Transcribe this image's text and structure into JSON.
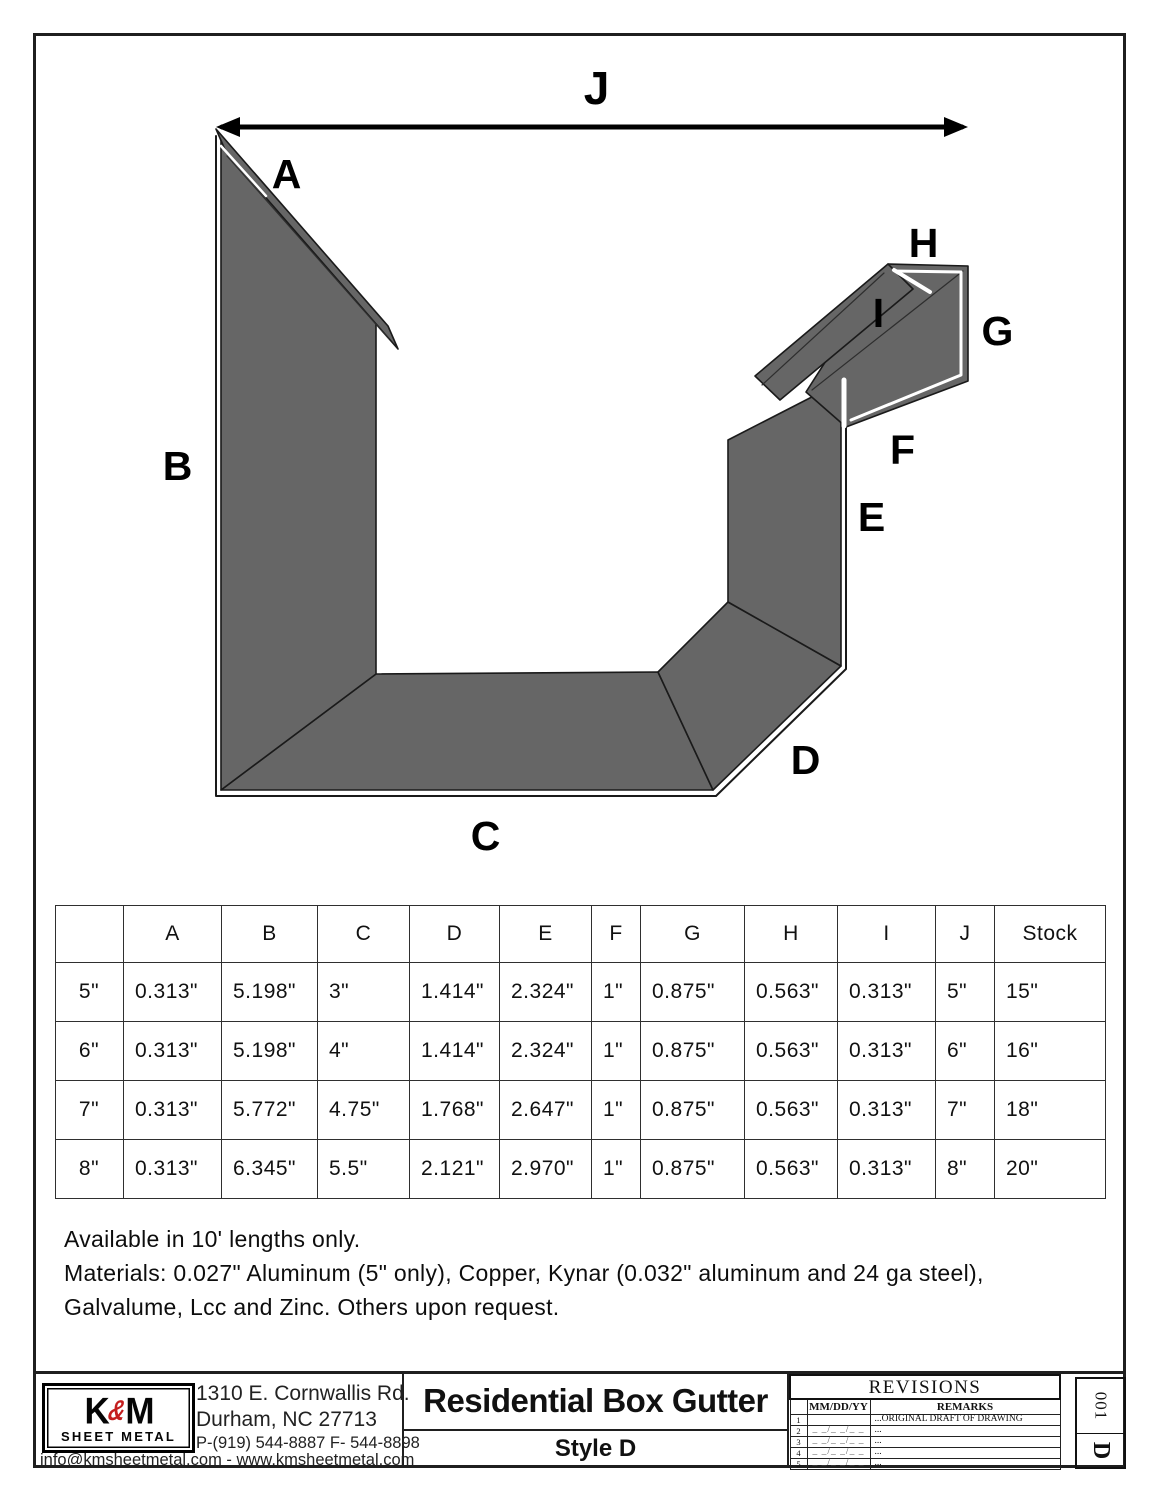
{
  "colors": {
    "metal_fill": "#666666",
    "outline": "#1a1a1a",
    "logo_red": "#c41e1e"
  },
  "diagram": {
    "labels": {
      "a": "A",
      "b": "B",
      "c": "C",
      "d": "D",
      "e": "E",
      "f": "F",
      "g": "G",
      "h": "H",
      "i": "I",
      "j": "J"
    }
  },
  "spec_table": {
    "columns": [
      "",
      "A",
      "B",
      "C",
      "D",
      "E",
      "F",
      "G",
      "H",
      "I",
      "J",
      "Stock"
    ],
    "rows": [
      {
        "size": "5\"",
        "cells": [
          "0.313\"",
          "5.198\"",
          "3\"",
          "1.414\"",
          "2.324\"",
          "1\"",
          "0.875\"",
          "0.563\"",
          "0.313\"",
          "5\"",
          "15\""
        ]
      },
      {
        "size": "6\"",
        "cells": [
          "0.313\"",
          "5.198\"",
          "4\"",
          "1.414\"",
          "2.324\"",
          "1\"",
          "0.875\"",
          "0.563\"",
          "0.313\"",
          "6\"",
          "16\""
        ]
      },
      {
        "size": "7\"",
        "cells": [
          "0.313\"",
          "5.772\"",
          "4.75\"",
          "1.768\"",
          "2.647\"",
          "1\"",
          "0.875\"",
          "0.563\"",
          "0.313\"",
          "7\"",
          "18\""
        ]
      },
      {
        "size": "8\"",
        "cells": [
          "0.313\"",
          "6.345\"",
          "5.5\"",
          "2.121\"",
          "2.970\"",
          "1\"",
          "0.875\"",
          "0.563\"",
          "0.313\"",
          "8\"",
          "20\""
        ]
      }
    ]
  },
  "notes": {
    "line1": "Available in 10' lengths only.",
    "line2": "Materials: 0.027\" Aluminum (5\" only), Copper, Kynar (0.032\" aluminum and 24 ga steel),",
    "line3": "Galvalume, Lcc and Zinc. Others upon request."
  },
  "title_block": {
    "logo": {
      "k": "K",
      "amp": "&",
      "m": "M",
      "subtitle": "SHEET METAL"
    },
    "address_line1": "1310 E. Cornwallis Rd.",
    "address_line2": "Durham, NC 27713",
    "phone_line": "P-(919) 544-8887 F- 544-8898",
    "email_line": "info@kmsheetmetal.com - www.kmsheetmetal.com",
    "title": "Residential Box Gutter",
    "subtitle": "Style D",
    "revisions": {
      "header": "REVISIONS",
      "col_date": "MM/DD/YY",
      "col_remarks": "REMARKS",
      "rows": [
        {
          "num": "1",
          "date": "",
          "remarks": "...ORIGINAL DRAFT OF DRAWING"
        },
        {
          "num": "2",
          "date": "_ _/_ _/_ _",
          "remarks": "..."
        },
        {
          "num": "3",
          "date": "_ _/_ _/_ _",
          "remarks": "..."
        },
        {
          "num": "4",
          "date": "_ _/_ _/_ _",
          "remarks": "..."
        },
        {
          "num": "5",
          "date": "_ _/_ _/_ _",
          "remarks": "..."
        }
      ]
    },
    "sheet_id": {
      "number": "001",
      "letter": "D"
    }
  }
}
